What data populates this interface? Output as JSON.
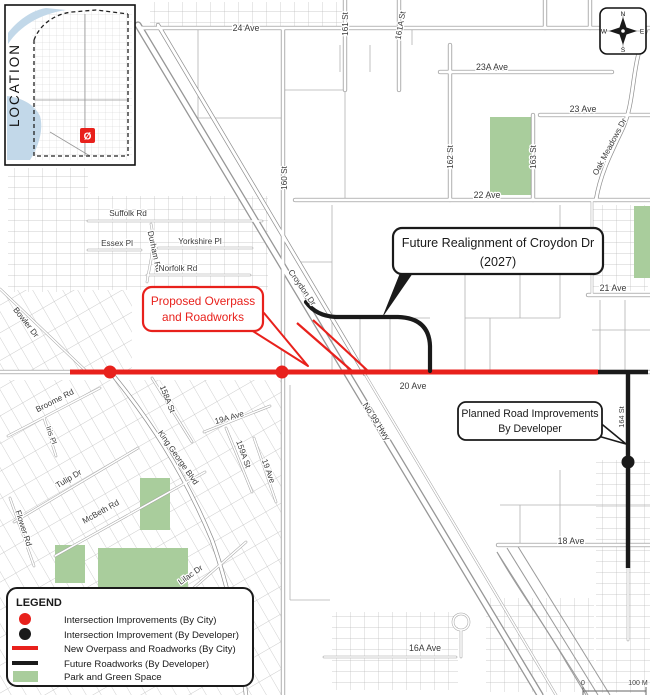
{
  "colors": {
    "city_red": "#e8211c",
    "developer_black": "#1a1a1a",
    "park_green": "#a9cd9c",
    "water_blue": "#c2d8e9",
    "road_gray": "#8e8e8e"
  },
  "inset": {
    "label": "LOCATION",
    "marker_glyph": "Ø"
  },
  "compass": {
    "n": "N",
    "e": "E",
    "s": "S",
    "w": "W"
  },
  "scale": {
    "zero": "0",
    "max": "100 M"
  },
  "streets": {
    "ave24": "24 Ave",
    "st161": "161 St",
    "st161a": "161A St",
    "ave23a": "23A Ave",
    "ave23": "23 Ave",
    "st162": "162 St",
    "st163": "163 St",
    "oak_meadows": "Oak Meadows Dr",
    "ave22": "22 Ave",
    "ave21": "21 Ave",
    "suffolk": "Suffolk Rd",
    "essex": "Essex Pl",
    "durham": "Durham Rd",
    "yorkshire": "Yorkshire Pl",
    "norfolk": "Norfolk Rd",
    "st160": "160 St",
    "croydon": "Croydon Dr",
    "bowler": "Bowler Dr",
    "ave20": "20 Ave",
    "hwy99": "No 99 Hwy",
    "st158a": "158A St",
    "ave19a": "19A Ave",
    "st159a": "159A St",
    "ave19": "19 Ave",
    "king_george": "King George Blvd",
    "broome": "Broome Rd",
    "iris": "Iris Pl",
    "tulip": "Tulip Dr",
    "mcbeth": "McBeth Rd",
    "flower": "Flower Rd",
    "lilac": "Lilac Dr",
    "st164": "164 St",
    "ave18": "18 Ave",
    "ave16a": "16A Ave"
  },
  "callouts": {
    "proposed_overpass": {
      "line1": "Proposed Overpass",
      "line2": "and Roadworks"
    },
    "future_realignment": {
      "line1": "Future Realignment of Croydon Dr",
      "line2": "(2027)"
    },
    "planned_road": {
      "line1": "Planned Road Improvements",
      "line2": "By Developer"
    }
  },
  "legend": {
    "title": "LEGEND",
    "items": [
      {
        "symbol": "red-dot",
        "label": "Intersection Improvements (By City)"
      },
      {
        "symbol": "black-dot",
        "label": "Intersection Improvement (By Developer)"
      },
      {
        "symbol": "red-line",
        "label": "New Overpass and Roadworks (By City)"
      },
      {
        "symbol": "black-line",
        "label": "Future Roadworks (By Developer)"
      },
      {
        "symbol": "green-square",
        "label": "Park and Green Space"
      }
    ]
  }
}
